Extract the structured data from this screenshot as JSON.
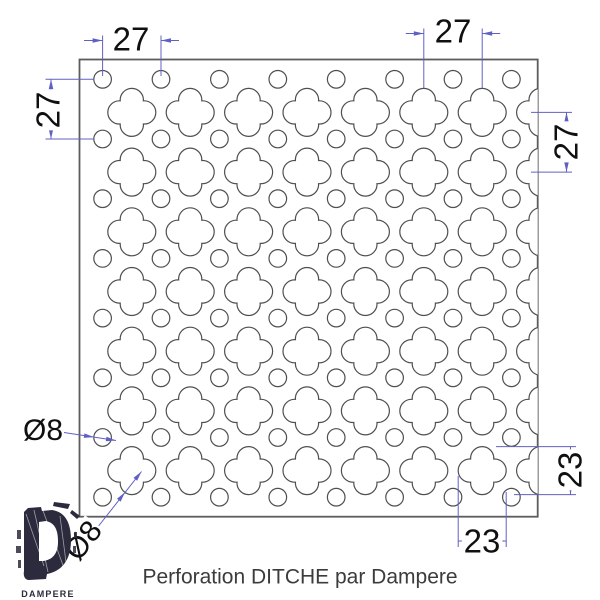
{
  "caption": "Perforation DITCHE par Dampere",
  "logo": {
    "brand": "DAMPERE"
  },
  "dimensions": {
    "circle_pitch_horizontal": "27",
    "circle_pitch_vertical": "27",
    "clover_pitch_horizontal": "27",
    "clover_pitch_vertical": "27",
    "clover_width": "23",
    "clover_height": "23",
    "circle_diameter": "Ø8",
    "clover_lobe_diameter": "Ø8"
  },
  "pattern": {
    "panel": {
      "x": 79.5,
      "y": 59.5,
      "width": 458.2,
      "height": 457.2
    },
    "pitch_x": 58.4,
    "pitch_y": 59.7,
    "circles": {
      "x0": 102.6,
      "y0": 79.3,
      "cols": 8,
      "rows": 8,
      "radius": 8.8
    },
    "clovers": {
      "x0": 131.8,
      "y0": 112.4,
      "cols": 8,
      "rows": 7,
      "lobe_radius": 11.6,
      "lobe_offset": 12.4,
      "notch": 11.57
    }
  },
  "colors": {
    "outline": "#4f4f4f",
    "panel_border": "#5c5c5c",
    "dimension": "#6060c4",
    "dim_text": "#101010",
    "caption_text": "#3c3c3c",
    "logo": "#2b2b3d"
  }
}
